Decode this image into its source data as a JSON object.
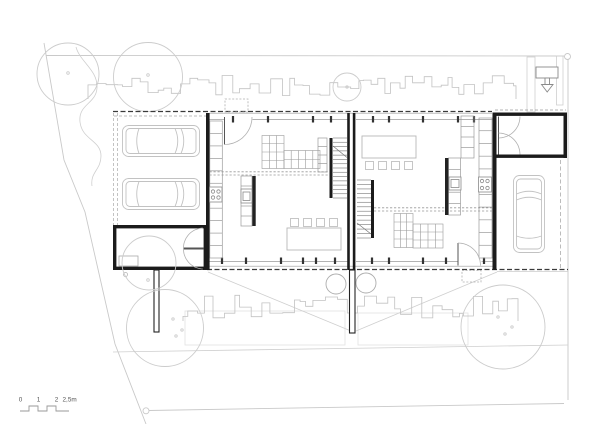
{
  "drawing": {
    "type": "architectural-site-floor-plan",
    "scale_bar": {
      "labels": [
        "0",
        "1",
        "2",
        "2,5m"
      ]
    },
    "colors": {
      "background": "#ffffff",
      "walls": "#1b1b1b",
      "medium_lines": "#8a8a8a",
      "light_lines": "#c9c9c9",
      "roof_dashed": "#3a3a3a"
    },
    "symbols": {
      "entrance_marker": "down-arrow-icon",
      "tree": "circle-with-center-dot",
      "car": "car-outline",
      "door": "quarter-circle-swing",
      "stair": "treads-with-direction-line"
    }
  }
}
